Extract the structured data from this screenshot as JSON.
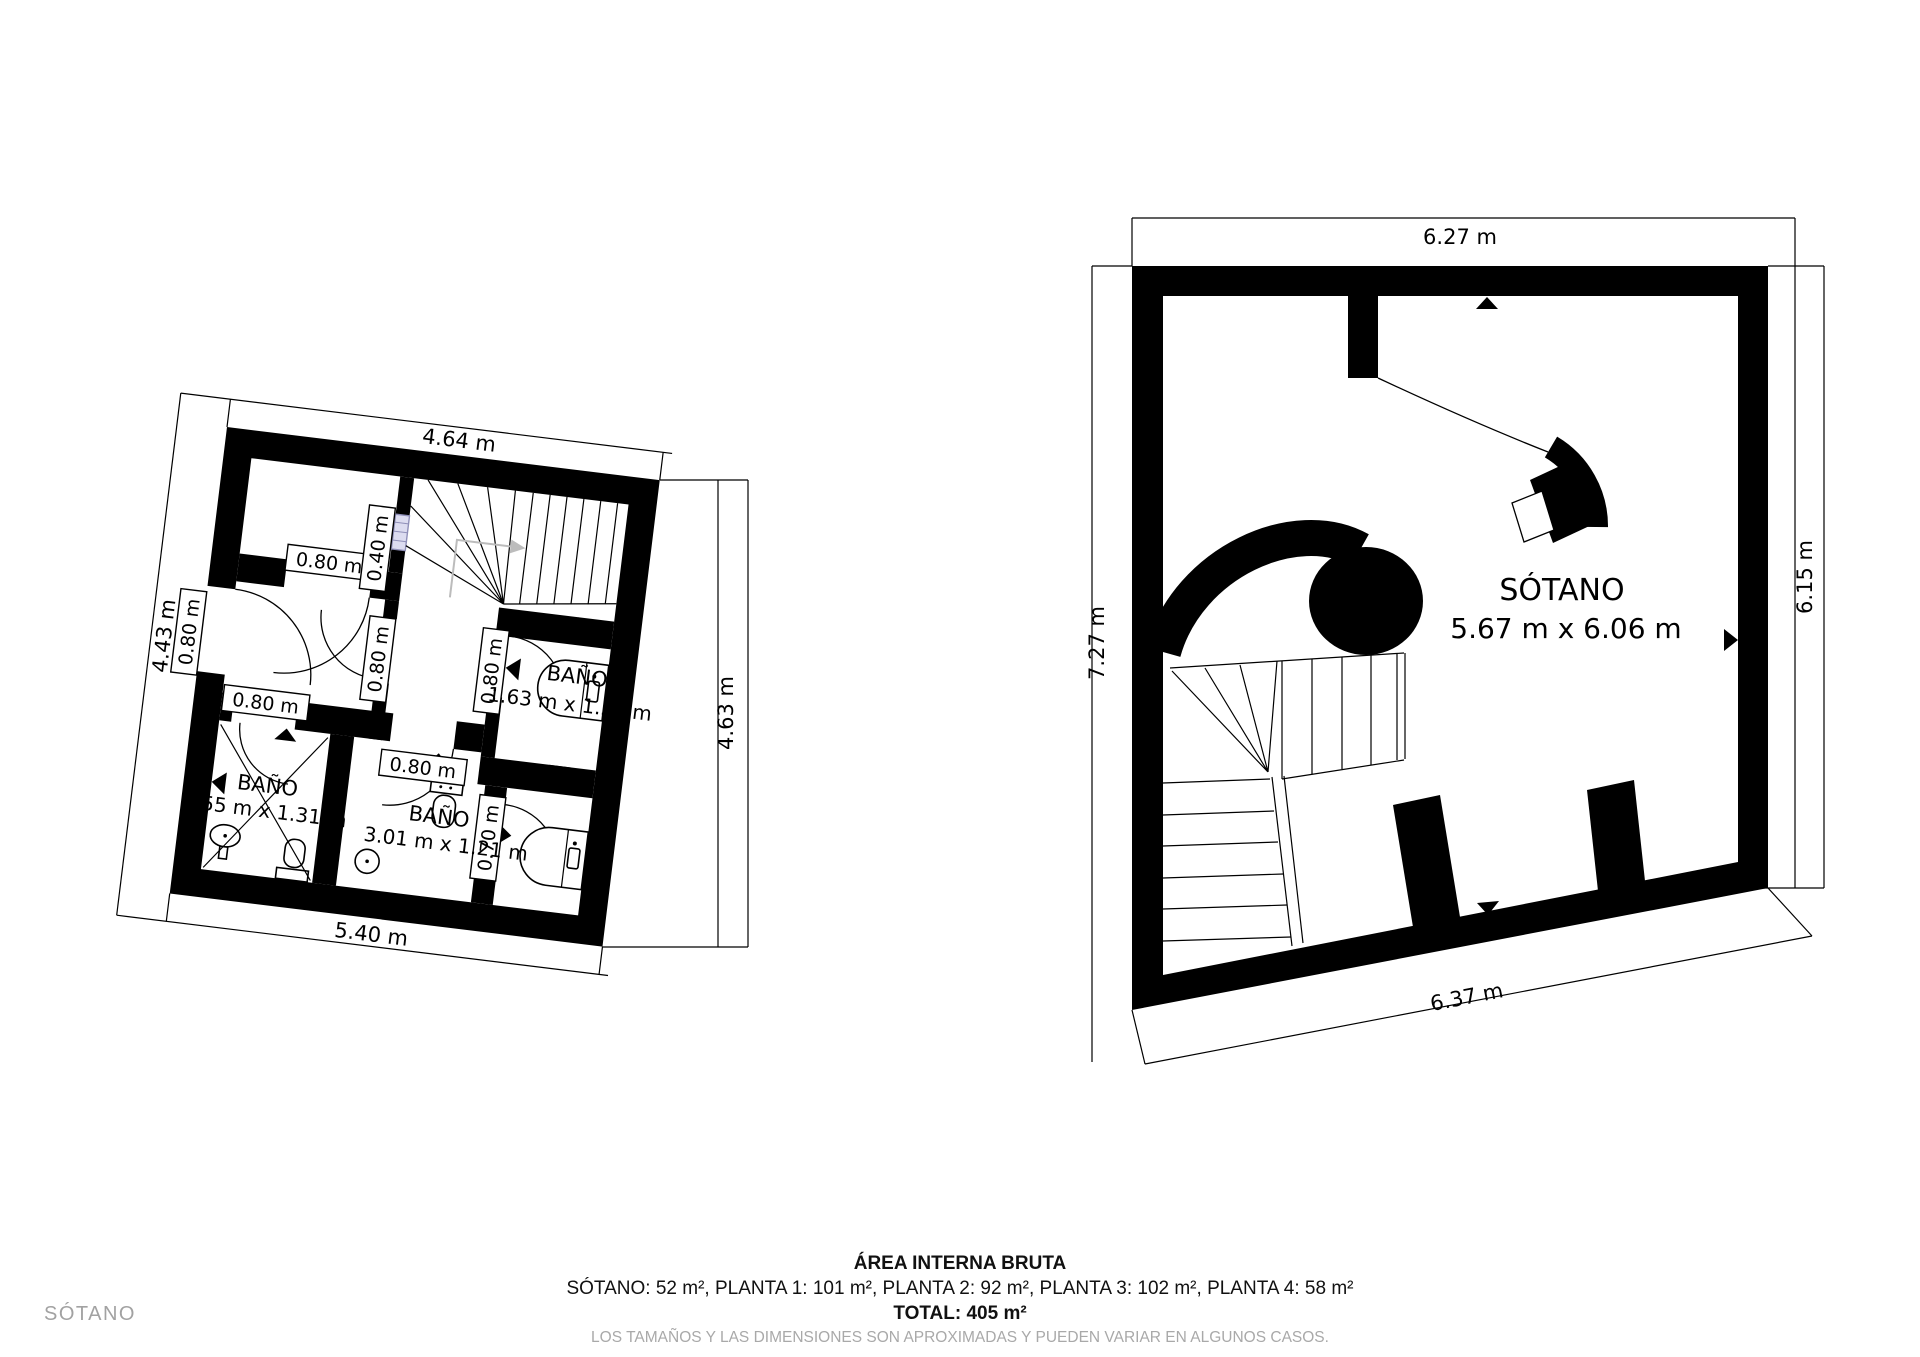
{
  "page": {
    "floor_tag": "SÓTANO"
  },
  "footer": {
    "title": "ÁREA INTERNA BRUTA",
    "areas": "SÓTANO: 52 m², PLANTA 1: 101 m², PLANTA 2: 92 m², PLANTA 3: 102 m², PLANTA 4: 58 m²",
    "total": "TOTAL: 405 m²",
    "disclaimer": "LOS TAMAÑOS Y LAS DIMENSIONES SON APROXIMADAS Y PUEDEN VARIAR EN ALGUNOS CASOS."
  },
  "left_plan": {
    "dim_top": "4.64 m",
    "dim_left": "4.43 m",
    "dim_right": "4.63 m",
    "dim_bottom": "5.40 m",
    "labels": {
      "r1_door": "0.80 m",
      "exterior_door": "0.80 m",
      "hall_left_door": "0.80 m",
      "hall_right_door": "0.80 m",
      "bath_left_door": "0.80 m",
      "bath_mid_door": "0.80 m",
      "window": "0.40 m",
      "bath_small_door": "0.70 m"
    },
    "rooms": {
      "bath_right": {
        "name": "BAÑO",
        "dims": "1.63 m x 1.51 m"
      },
      "bath_left": {
        "name": "BAÑO",
        "dims": "1.55 m x 1.31 m"
      },
      "bath_mid": {
        "name": "BAÑO",
        "dims": "3.01 m x 1.21 m"
      }
    }
  },
  "right_plan": {
    "dim_top": "6.27 m",
    "dim_left": "7.27 m",
    "dim_right": "6.15 m",
    "dim_bottom": "6.37 m",
    "room": {
      "name": "SÓTANO",
      "dims": "5.67 m x 6.06 m"
    }
  },
  "colors": {
    "wall": "#000000",
    "window_fill": "#dcdcf0",
    "window_stroke": "#8f8fb8",
    "guide_gray": "#bcbcbc",
    "muted_text": "#a9a9a9"
  }
}
